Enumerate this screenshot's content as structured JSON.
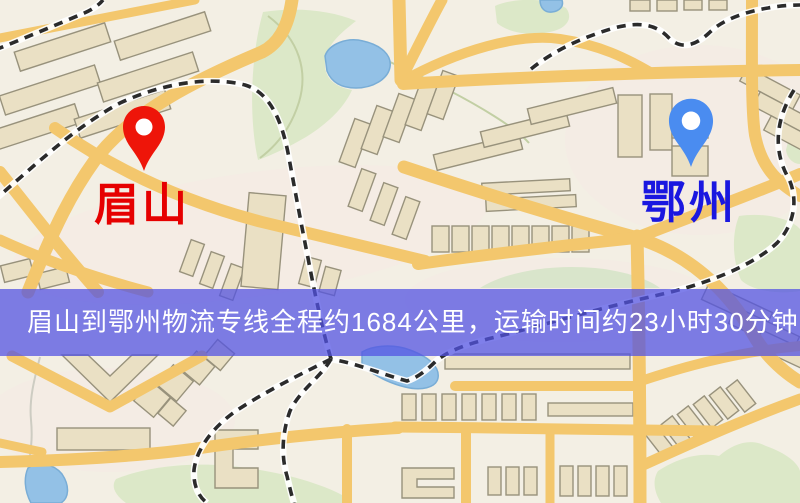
{
  "banner": {
    "text": "眉山到鄂州物流专线全程约1684公里，运输时间约23小时30分钟.",
    "background_color": "rgba(82,82,226,0.74)",
    "text_color": "#ffffff"
  },
  "markers": {
    "origin": {
      "label": "眉山",
      "pin_color": "#ee1509",
      "pin_hole_color": "#ffffff",
      "label_color": "#e60000"
    },
    "destination": {
      "label": "鄂州",
      "pin_color": "#4a8cf0",
      "pin_hole_color": "#ffffff",
      "label_color": "#1a17e0"
    }
  },
  "map_colors": {
    "background": "#f3efe4",
    "urban_tint": "#f6e9e4",
    "road": "#f3c76d",
    "building": "#eae0c4",
    "park": "#dce8c8",
    "park_light": "#d9e5cb",
    "water": "#93c1e6",
    "railway": "#2b2b2b"
  }
}
